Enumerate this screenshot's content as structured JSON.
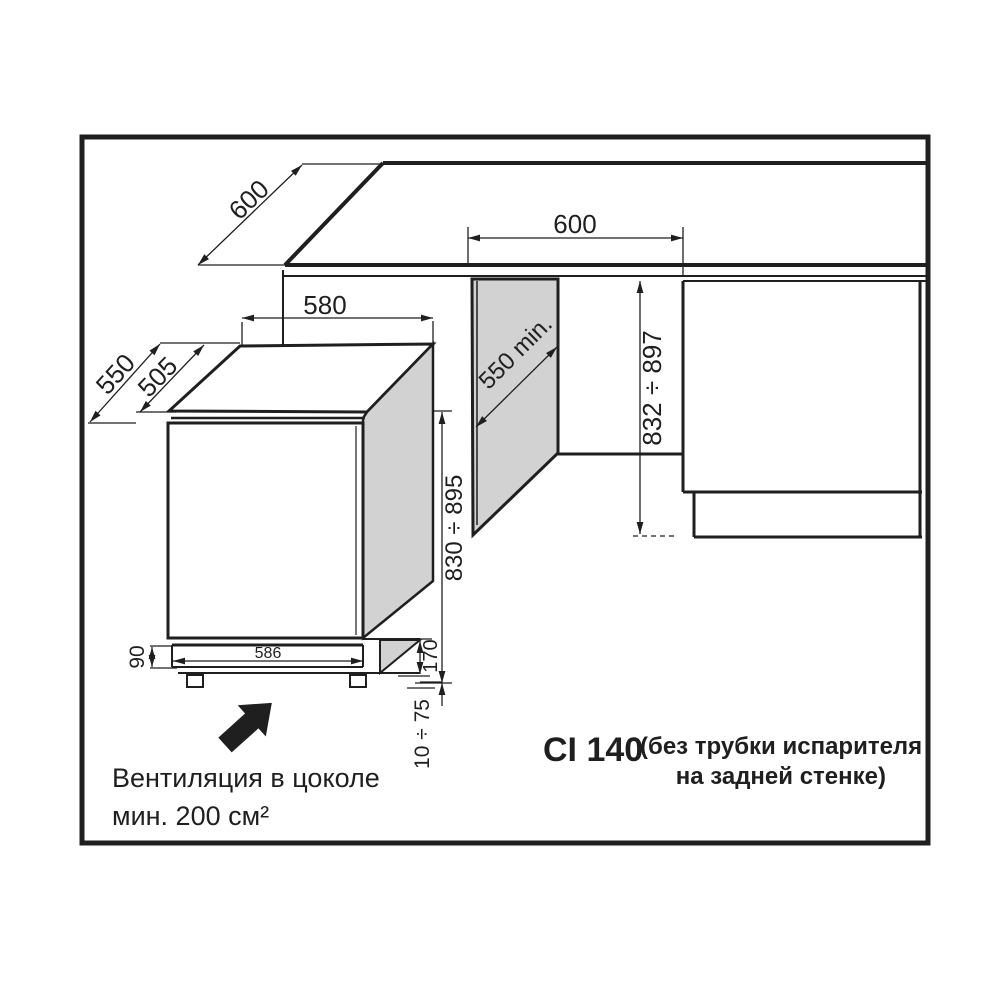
{
  "title_block": {
    "model": "CI 140",
    "note_line1": "(без трубки испарителя",
    "note_line2": "на задней стенке)"
  },
  "ventilation_note": {
    "line1": "Вентиляция в цоколе",
    "line2": "мин. 200 см²"
  },
  "dimensions": {
    "counter_depth": "600",
    "niche_width": "600",
    "appliance_top_width": "580",
    "appliance_depth_total": "550",
    "appliance_depth_body": "505",
    "niche_depth_min": "550 min.",
    "niche_height_range": "832 ÷ 897",
    "appliance_height_range": "830 ÷ 895",
    "plinth_height": "90",
    "plinth_front_width": "586",
    "plinth_recess_depth": "170",
    "feet_adjust_range": "10 ÷ 75"
  },
  "colors": {
    "line": "#1f1f1f",
    "panel_gray": "#d2d2d2",
    "background": "#ffffff"
  }
}
